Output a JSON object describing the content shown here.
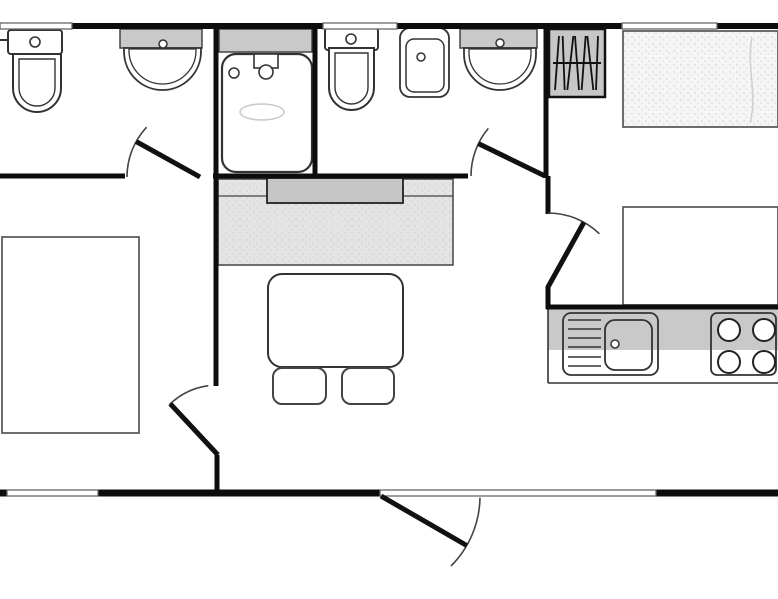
{
  "diagram": {
    "type": "floor-plan",
    "canvas": {
      "width": 778,
      "height": 599,
      "background": "#ffffff"
    },
    "colors": {
      "wall": "#0d0d0d",
      "line": "#333333",
      "thin": "#666666",
      "grayBand": "#c9c9c9",
      "grayDark": "#c6c6c6",
      "grayLight": "#e3e3e3",
      "stippleBase": "#f5f5f5",
      "stippleDot": "#d8d8d8",
      "seatBase": "#e4e4e4",
      "seatDot": "#d2d2d2",
      "white": "#ffffff"
    },
    "walls": [
      [
        72,
        26,
        323,
        26,
        6
      ],
      [
        397,
        26,
        622,
        26,
        6
      ],
      [
        717,
        26,
        778,
        26,
        6
      ],
      [
        0,
        493,
        8,
        493,
        7
      ],
      [
        98,
        493,
        381,
        493,
        7
      ],
      [
        656,
        493,
        778,
        493,
        7
      ],
      [
        216,
        23,
        216,
        386,
        5
      ],
      [
        217,
        455,
        217,
        496,
        5
      ],
      [
        315,
        23,
        315,
        176,
        5
      ],
      [
        0,
        176,
        125,
        176,
        5
      ],
      [
        213,
        176,
        468,
        176,
        5
      ],
      [
        546,
        23,
        546,
        178,
        5
      ],
      [
        548,
        176,
        548,
        214,
        5
      ],
      [
        548,
        286,
        548,
        309,
        5
      ],
      [
        546,
        307,
        778,
        307,
        5
      ]
    ],
    "windows": [
      [
        0,
        26,
        72
      ],
      [
        323,
        26,
        74
      ],
      [
        622,
        26,
        95
      ],
      [
        7,
        493,
        91
      ],
      [
        380,
        493,
        276
      ]
    ],
    "doors": [
      {
        "name": "door-bathroom-left",
        "hinge": [
          200,
          177
        ],
        "r": 73,
        "leaf": 209,
        "arc": [
          180,
          223
        ]
      },
      {
        "name": "door-bathroom-middle",
        "hinge": [
          545,
          176
        ],
        "r": 74,
        "leaf": 206,
        "arc": [
          180,
          220
        ]
      },
      {
        "name": "door-bedroom-right",
        "hinge": [
          548,
          287
        ],
        "r": 74,
        "leaf": 299,
        "arc": [
          270,
          314
        ]
      },
      {
        "name": "door-bedroom-left",
        "hinge": [
          218,
          455
        ],
        "r": 70,
        "leaf": 227,
        "arc": [
          262,
          226
        ]
      },
      {
        "name": "door-entrance",
        "hinge": [
          381,
          496
        ],
        "r": 99,
        "leaf": 30,
        "arc": [
          1,
          45
        ]
      }
    ],
    "fixtures": [
      {
        "kind": "toilet",
        "name": "toilet-left",
        "cistern": [
          8,
          30,
          54,
          24
        ],
        "button": [
          35,
          42,
          5
        ],
        "bowl": [
          13,
          54,
          48,
          58
        ],
        "supply": [
          0,
          40,
          8,
          40
        ]
      },
      {
        "kind": "toilet",
        "name": "toilet-middle",
        "cistern": [
          325,
          28,
          53,
          22
        ],
        "button": [
          351,
          39,
          5
        ],
        "bowl": [
          329,
          48,
          45,
          62
        ]
      },
      {
        "kind": "basin-half",
        "name": "washbasin-left",
        "band": [
          120,
          29,
          82,
          19
        ],
        "bowl": [
          124,
          48,
          77,
          42
        ],
        "tap": [
          163,
          44,
          4
        ]
      },
      {
        "kind": "basin-half",
        "name": "washbasin-right",
        "band": [
          460,
          29,
          77,
          19
        ],
        "bowl": [
          464,
          48,
          72,
          42
        ],
        "tap": [
          500,
          43,
          4
        ]
      },
      {
        "kind": "shower",
        "name": "shower",
        "shelf": [
          219,
          29,
          93,
          23
        ],
        "tray": [
          222,
          54,
          90,
          118
        ],
        "head": [
          254,
          54,
          24,
          14
        ],
        "headDot": [
          266,
          72,
          7
        ],
        "cornerDot": [
          234,
          73,
          5
        ],
        "puddle": [
          262,
          112,
          22,
          8
        ]
      },
      {
        "kind": "basin-square",
        "name": "washbasin-middle",
        "outer": [
          400,
          28,
          49,
          69
        ],
        "inner": [
          406,
          39,
          38,
          53
        ],
        "dot": [
          421,
          57,
          4
        ]
      },
      {
        "kind": "wardrobe",
        "name": "wardrobe",
        "rect": [
          549,
          29,
          56,
          68
        ],
        "rodY": 63,
        "tilts": [
          2,
          -1,
          3,
          -2,
          2,
          -3,
          1
        ]
      },
      {
        "kind": "bed",
        "name": "bed-right-top",
        "rect": [
          623,
          31,
          155,
          96
        ],
        "textured": true
      },
      {
        "kind": "bed",
        "name": "bed-right-bottom",
        "rect": [
          623,
          207,
          155,
          98
        ],
        "textured": false
      },
      {
        "kind": "bed",
        "name": "bed-left",
        "rect": [
          2,
          237,
          137,
          196
        ],
        "textured": false
      },
      {
        "kind": "dinette",
        "name": "dinette-bench",
        "seat": [
          218,
          179,
          235,
          86
        ],
        "seamY": 196,
        "back": [
          267,
          178,
          136,
          25
        ]
      },
      {
        "kind": "table",
        "name": "dining-table",
        "rect": [
          268,
          274,
          135,
          93
        ]
      },
      {
        "kind": "chair",
        "name": "chair-left",
        "rect": [
          273,
          368,
          53,
          36
        ]
      },
      {
        "kind": "chair",
        "name": "chair-right",
        "rect": [
          342,
          368,
          52,
          36
        ]
      },
      {
        "kind": "counter",
        "name": "kitchen-counter",
        "rect": [
          548,
          309,
          230,
          74
        ],
        "grayH": 41
      },
      {
        "kind": "sink-unit",
        "name": "kitchen-sink",
        "outer": [
          563,
          313,
          95,
          62
        ],
        "drainerX": [
          568,
          601
        ],
        "lines": [
          320,
          329,
          338,
          347,
          357,
          366
        ],
        "basin": [
          605,
          320,
          47,
          50
        ],
        "dot": [
          615,
          344,
          4
        ]
      },
      {
        "kind": "hob",
        "name": "hob",
        "rect": [
          711,
          313,
          65,
          62
        ],
        "burners": [
          [
            729,
            330
          ],
          [
            764,
            330
          ],
          [
            729,
            362
          ],
          [
            764,
            362
          ]
        ],
        "burnerR": 11
      }
    ]
  }
}
